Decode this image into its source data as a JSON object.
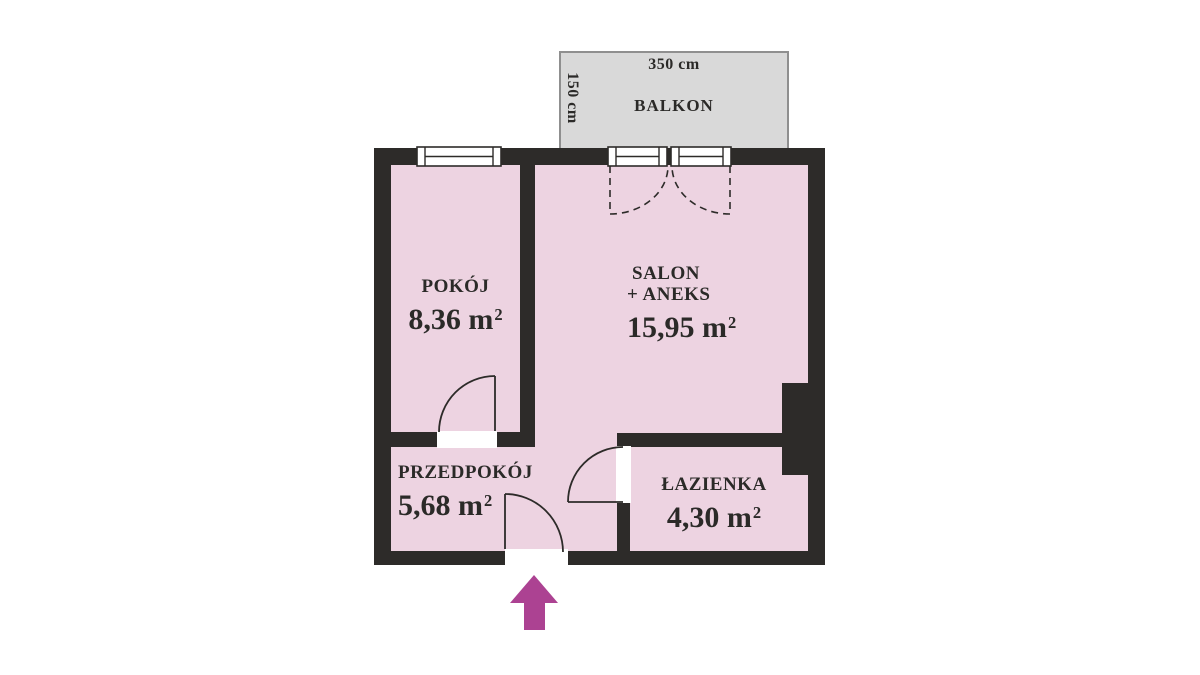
{
  "balcony": {
    "label": "BALKON",
    "width_dim": "350 cm",
    "depth_dim": "150 cm"
  },
  "rooms": [
    {
      "id": "pokoj",
      "name": "POKÓJ",
      "area": "8,36 m",
      "area_sup": "2"
    },
    {
      "id": "salon",
      "name": "SALON",
      "name_line2": "+ ANEKS",
      "area": "15,95 m",
      "area_sup": "2"
    },
    {
      "id": "przedpokoj",
      "name": "PRZEDPOKÓJ",
      "area": "5,68 m",
      "area_sup": "2"
    },
    {
      "id": "lazienka",
      "name": "ŁAZIENKA",
      "area": "4,30 m",
      "area_sup": "2"
    }
  ],
  "icons": {
    "entrance_arrow": "up-arrow",
    "window": "double-line-window",
    "balcony_door": "double-door-window",
    "door_swing": "quarter-arc-door-swing"
  },
  "colors": {
    "room_fill": "#edd3e1",
    "wall": "#2d2b29",
    "balcony_fill": "#d9d9d9",
    "balcony_border": "#8f8f8f",
    "opening_white": "#ffffff",
    "entrance_arrow": "#ac4292",
    "text": "#2b2a28"
  }
}
